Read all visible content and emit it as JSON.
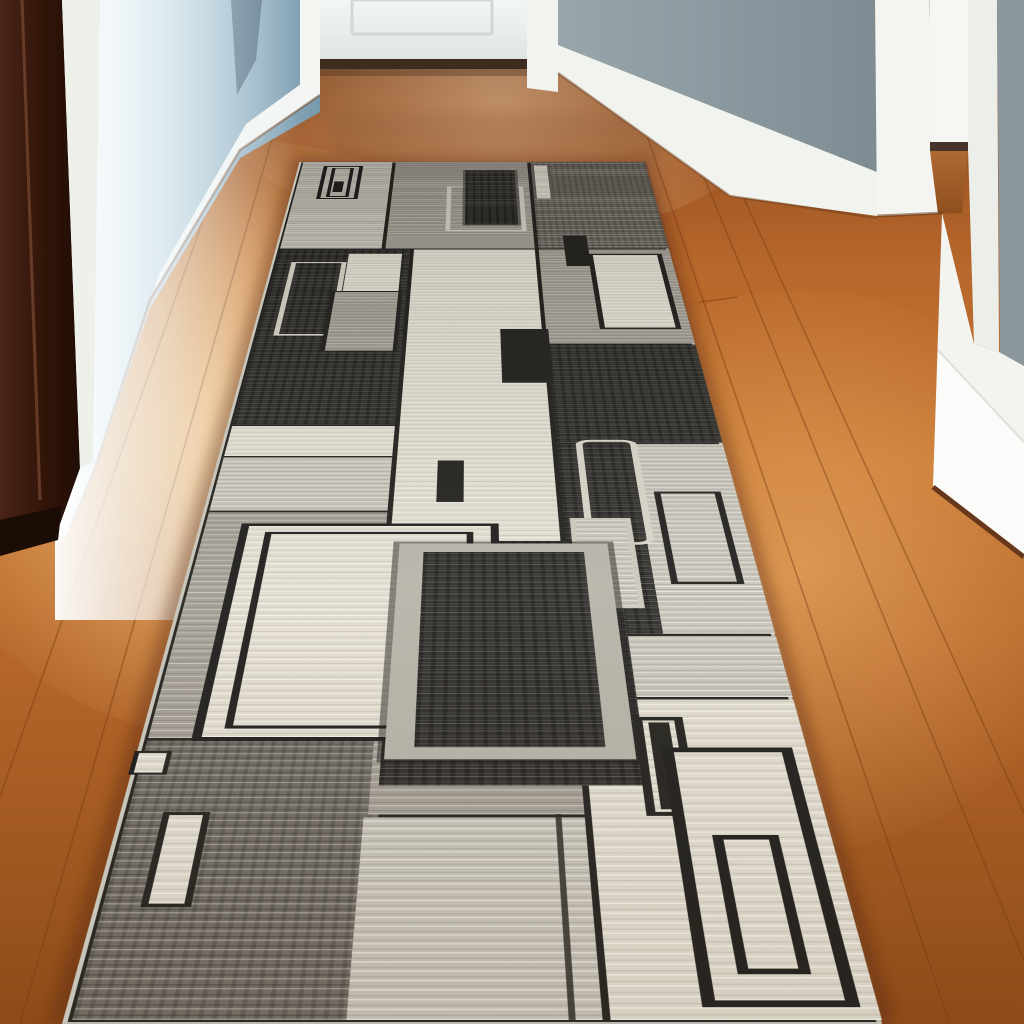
{
  "scene": {
    "description": "Photograph of a hallway with warm hardwood floor, blue-gray and white walls, a white door at the far end, a dark brown door frame at left, white doorway casings at right, and a long geometric gray runner rug",
    "text_content": "none"
  },
  "palette": {
    "wood_mid": "#b8682c",
    "wood_dark": "#8e4a1a",
    "wood_highlight": "#e8a55f",
    "wall_blue": "#9fbccb",
    "wall_slate": "#5b7487",
    "wall_gray_right": "#8b979d",
    "trim_white": "#f2f5f3",
    "door_white": "#f1f4f2",
    "door_frame_brown": "#2a1209",
    "rug_black": "#2f2e2b",
    "rug_dark_gray": "#716d66",
    "rug_mid_gray": "#a49f96",
    "rug_light_gray": "#c8c4ba",
    "rug_cream": "#e2ddd0",
    "rug_outline_dark": "#23221f",
    "rug_outline_light": "#d8d4c8",
    "rug_binding": "#c8c5bb"
  },
  "rug": {
    "layers": [
      {
        "n": "patch-lgray-top-left",
        "tex": "tex-lgray",
        "x": 0,
        "d": 3230,
        "w": 220,
        "h": 868,
        "patch": true
      },
      {
        "n": "patch-mgray-top-center",
        "tex": "tex-mgray",
        "x": 220,
        "d": 3230,
        "w": 320,
        "h": 868,
        "patch": true
      },
      {
        "n": "patch-dgray-top-right",
        "tex": "tex-dgray",
        "x": 540,
        "d": 3230,
        "w": 280,
        "h": 868,
        "patch": true
      },
      {
        "n": "patch-black-left",
        "tex": "tex-black",
        "x": 0,
        "d": 2000,
        "w": 280,
        "h": 1230,
        "patch": true
      },
      {
        "n": "patch-cream-center",
        "tex": "tex-cream",
        "x": 280,
        "d": 700,
        "w": 260,
        "h": 2530,
        "patch": true
      },
      {
        "n": "patch-mgray-right",
        "tex": "tex-mgray",
        "x": 540,
        "d": 2500,
        "w": 280,
        "h": 730,
        "patch": true
      },
      {
        "n": "patch-cream-strip-left",
        "tex": "tex-cream",
        "x": 0,
        "d": 1830,
        "w": 280,
        "h": 170,
        "patch": true
      },
      {
        "n": "patch-lgray-left",
        "tex": "tex-lgray",
        "x": 0,
        "d": 1560,
        "w": 280,
        "h": 270,
        "patch": true
      },
      {
        "n": "patch-mgray-left",
        "tex": "tex-mgray",
        "x": 0,
        "d": 700,
        "w": 280,
        "h": 860,
        "patch": true
      },
      {
        "n": "patch-black-right-upper",
        "tex": "tex-black",
        "x": 540,
        "d": 1900,
        "w": 280,
        "h": 600,
        "patch": true
      },
      {
        "n": "patch-black-right",
        "tex": "tex-black",
        "x": 540,
        "d": 1050,
        "w": 130,
        "h": 850,
        "patch": true
      },
      {
        "n": "patch-lgray-strip-right",
        "tex": "tex-lgray",
        "x": 660,
        "d": 1050,
        "w": 160,
        "h": 850,
        "patch": true
      },
      {
        "n": "patch-lgray-band-right",
        "tex": "tex-lgray",
        "x": 540,
        "d": 830,
        "w": 280,
        "h": 220,
        "patch": true
      },
      {
        "n": "patch-cream-bottom-right",
        "tex": "tex-cream",
        "x": 540,
        "d": 0,
        "w": 280,
        "h": 830,
        "patch": true
      },
      {
        "n": "patch-dgray-bottom-left",
        "tex": "tex-dgray",
        "x": 0,
        "d": 0,
        "w": 300,
        "h": 700,
        "patch": true
      },
      {
        "n": "patch-mgray-bottom-center",
        "tex": "tex-mgray",
        "x": 280,
        "d": 480,
        "w": 260,
        "h": 220,
        "patch": true
      },
      {
        "n": "patch-lgray-bottom-center",
        "tex": "tex-lgray",
        "x": 275,
        "d": 0,
        "w": 265,
        "h": 480,
        "patch": true
      },
      {
        "n": "patch-black-center",
        "tex": "tex-black",
        "x": 290,
        "d": 560,
        "w": 330,
        "h": 870,
        "patch": true
      },
      {
        "n": "motif-cream-square-topleft",
        "tex": "tex-cream",
        "x": 150,
        "d": 2870,
        "w": 110,
        "h": 320
      },
      {
        "n": "motif-white-outline-top",
        "x": 348,
        "d": 3390,
        "w": 174,
        "h": 440,
        "border": "10px solid #d9d5c9"
      },
      {
        "n": "motif-black-rect-top",
        "tex": "tex-black",
        "x": 390,
        "d": 3450,
        "w": 115,
        "h": 550,
        "shadow": "0 0 0 6px rgba(25,24,22,0.45)"
      },
      {
        "n": "motif-double-square",
        "x": 55,
        "d": 3700,
        "w": 93,
        "h": 350,
        "border": "9px solid #1d1c1a",
        "children": [
          {
            "n": "motif-double-square-inner",
            "x": 12,
            "d": 12,
            "w": 51,
            "h": 308,
            "border": "8px solid #1d1c1a"
          },
          {
            "n": "motif-double-square-dot",
            "x": 24,
            "d": 60,
            "w": 22,
            "h": 110,
            "bg": "#1d1c1a"
          }
        ]
      },
      {
        "n": "motif-cream-bar-topright",
        "tex": "tex-cream",
        "x": 545,
        "d": 3700,
        "w": 43,
        "h": 360,
        "border": "6px solid rgba(35,33,30,0.65)"
      },
      {
        "n": "motif-black-sq-right",
        "x": 598,
        "d": 3085,
        "w": 50,
        "h": 265,
        "bg": "#24231f"
      },
      {
        "n": "motif-white-outline-left",
        "x": 35,
        "d": 2560,
        "w": 113,
        "h": 560,
        "border": "10px solid #d8d4c8"
      },
      {
        "n": "motif-mgray-rect-left",
        "tex": "tex-mgray",
        "x": 128,
        "d": 2450,
        "w": 140,
        "h": 435,
        "border": "8px solid #23221f"
      },
      {
        "n": "motif-cream-outline-right",
        "tex": "tex-cream",
        "x": 645,
        "d": 2605,
        "w": 153,
        "h": 585,
        "border": "10px solid #23221f"
      },
      {
        "n": "motif-black-bar-center1",
        "x": 458,
        "d": 2250,
        "w": 90,
        "h": 355,
        "bg": "#24231f"
      },
      {
        "n": "motif-black-bar-center2",
        "x": 350,
        "d": 1605,
        "w": 42,
        "h": 205,
        "bg": "#24231f"
      },
      {
        "n": "motif-white-rounded-outline",
        "x": 575,
        "d": 1410,
        "w": 100,
        "h": 510,
        "border": "11px solid #d8d4c8",
        "radius": "26px"
      },
      {
        "n": "motif-lgray-rect-right",
        "tex": "tex-lgray",
        "x": 553,
        "d": 1150,
        "w": 92,
        "h": 380,
        "border": "8px solid #ccc8bc"
      },
      {
        "n": "motif-black-outline-strip",
        "x": 688,
        "d": 1245,
        "w": 104,
        "h": 410,
        "border": "10px solid #23221f"
      },
      {
        "n": "motif-big-double-outline",
        "tex": "tex-cream",
        "x": 58,
        "d": 695,
        "w": 387,
        "h": 810,
        "border": "12px solid #1f1e1c",
        "children": [
          {
            "n": "motif-big-double-outline-inner",
            "x": 26,
            "d": 26,
            "w": 311,
            "h": 734,
            "border": "10px solid #1f1e1c"
          }
        ]
      },
      {
        "n": "motif-framed-black-panel",
        "tex": "tex-black",
        "x": 298,
        "d": 640,
        "w": 307,
        "h": 775,
        "border": "36px solid #b8b4aa",
        "shadow": "0 0 0 9px rgba(25,24,22,0.5)"
      },
      {
        "n": "motif-cream-bar-bottomleft",
        "tex": "tex-cream",
        "x": 45,
        "d": 250,
        "w": 55,
        "h": 240,
        "border": "8px solid #23221f"
      },
      {
        "n": "motif-cream-bar-edge",
        "tex": "tex-cream",
        "x": -8,
        "d": 595,
        "w": 46,
        "h": 70,
        "border": "6px solid #23221f"
      },
      {
        "n": "motif-black-frame-small",
        "tex": "tex-cream",
        "x": 608,
        "d": 480,
        "w": 62,
        "h": 290,
        "border": "11px solid #23221f",
        "children": [
          {
            "n": "motif-black-frame-small-fill",
            "x": 7,
            "d": 7,
            "w": 26,
            "h": 254,
            "bg": "#24231f"
          }
        ]
      },
      {
        "n": "motif-black-frame-large",
        "tex": "tex-cream",
        "x": 638,
        "d": 30,
        "w": 160,
        "h": 645,
        "border": "14px solid #1f1e1c",
        "children": [
          {
            "n": "motif-black-frame-large-inner",
            "x": 28,
            "d": 55,
            "w": 76,
            "h": 330,
            "border": "12px solid #1f1e1c"
          }
        ]
      },
      {
        "n": "motif-dark-seam-line",
        "x": 502,
        "d": 0,
        "w": 7,
        "h": 485,
        "bg": "rgba(42,40,36,0.85)"
      },
      {
        "n": "rug-lighting-overlay",
        "x": 0,
        "d": 0,
        "w": 820,
        "h": 4098,
        "bg": "linear-gradient(to top, rgba(115,88,60,0.10) 0%, rgba(255,255,255,0.05) 30%, rgba(32,30,26,0.10) 75%, rgba(30,28,24,0.22) 100%)"
      }
    ]
  }
}
